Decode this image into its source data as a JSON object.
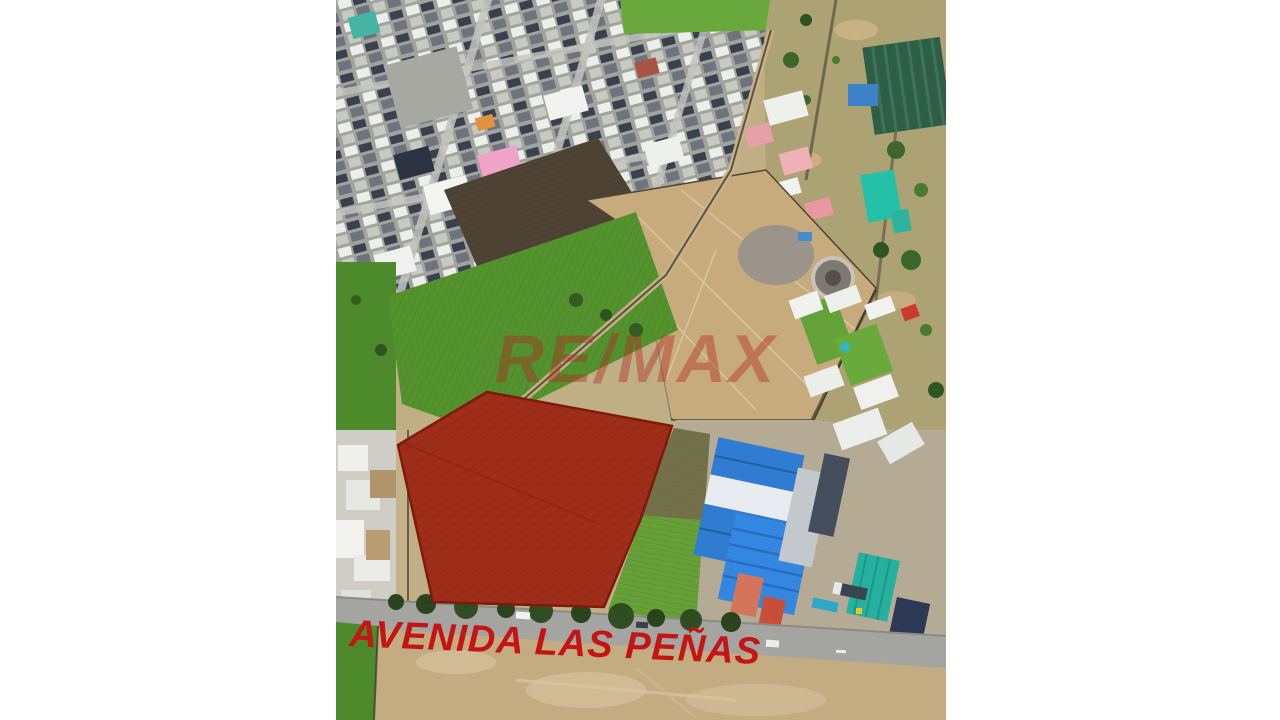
{
  "page": {
    "background_color": "#ffffff"
  },
  "photo": {
    "watermark": {
      "text": "RE/MAX",
      "color": "#b22c24"
    },
    "street_label": {
      "text": "AVENIDA LAS PEÑAS",
      "color": "#c41414"
    },
    "highlight": {
      "fill": "#9e2e1a",
      "stroke": "#7e1a0c"
    }
  }
}
